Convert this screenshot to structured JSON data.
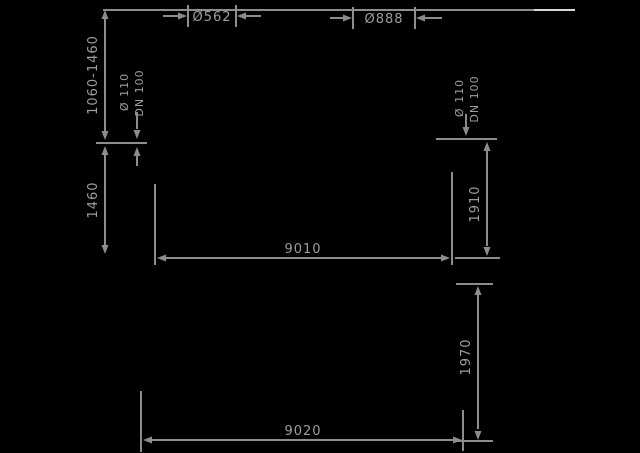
{
  "figure": {
    "type": "technical-dimension-drawing",
    "background_color": "#000000",
    "line_color": "#8d8d8d",
    "text_color": "#9e9e9e",
    "front_view": {
      "shaft_width_label": "Ø562",
      "dome_width_label": "Ø888",
      "cover_depth_range": "1060-1460",
      "inlet_depth": "1460",
      "inlet_pipe_diameter": "Ø 110",
      "inlet_pipe_dn": "DN 100",
      "outlet_pipe_diameter": "Ø 110",
      "outlet_pipe_dn": "DN 100",
      "outlet_invert_height": "1910",
      "overall_length": "9010"
    },
    "side_view": {
      "overall_height": "1970",
      "overall_length": "9020"
    }
  }
}
